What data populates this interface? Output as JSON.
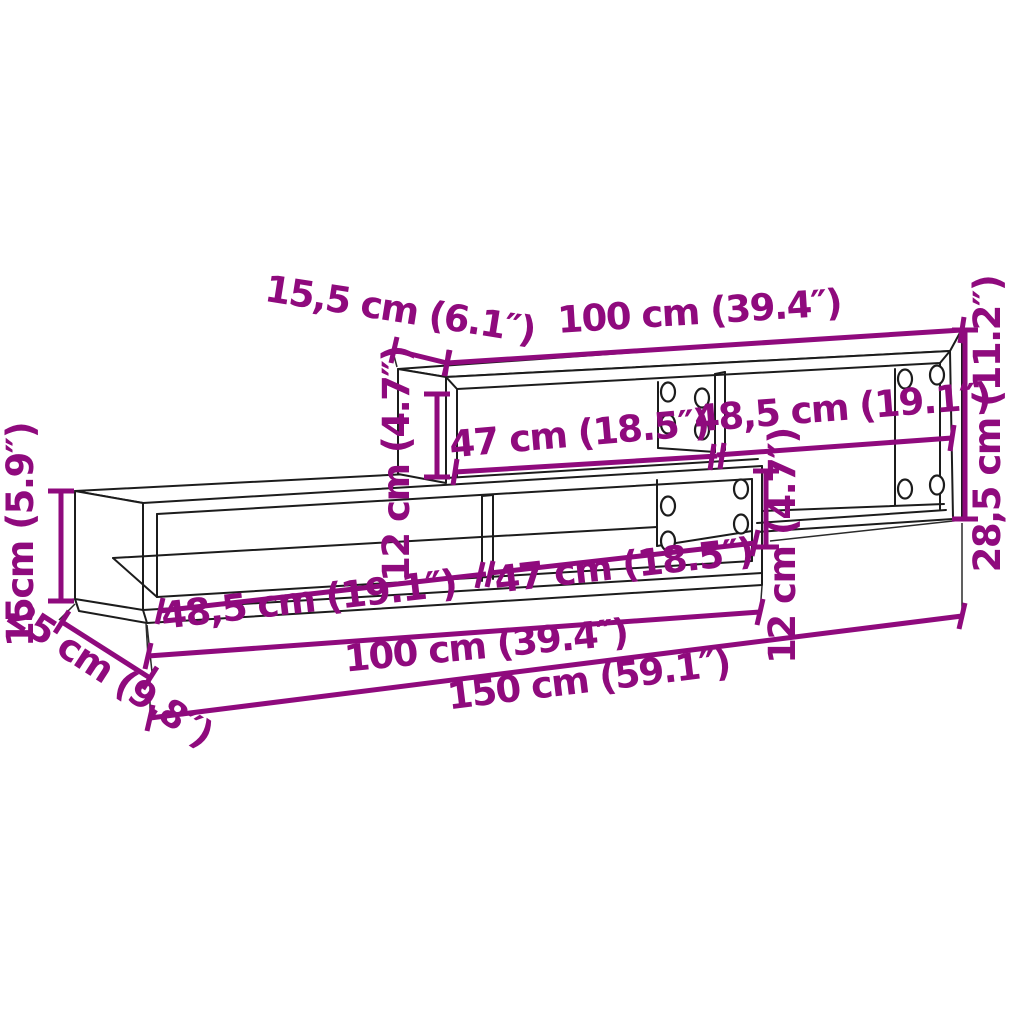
{
  "figure": {
    "type": "furniture-dimension-diagram",
    "product": "wall-mounted staggered TV shelf unit (two modules)",
    "colors": {
      "dimension_annotations": "#8F0A7D",
      "line_art": "#1C1C1C",
      "background": "#FFFFFF"
    },
    "dimensions": {
      "top_depth": "15,5 cm (6.1″)",
      "top_width": "100 cm (39.4″)",
      "total_height_right": "28,5 cm (11.2″)",
      "upper_left_compartment": "47 cm (18.5″)",
      "upper_right_compartment": "48,5 cm (19.1″)",
      "upper_inner_height": "12 cm (4.7″)",
      "lower_left_compartment": "48,5 cm (19.1″)",
      "lower_right_compartment": "47 cm (18.5″)",
      "lower_inner_height": "12 cm (4.7″)",
      "left_height": "15cm (5.9″)",
      "bottom_depth": "25 cm (9.8″)",
      "lower_width": "100 cm (39.4″)",
      "total_width": "150 cm (59.1″)"
    }
  }
}
